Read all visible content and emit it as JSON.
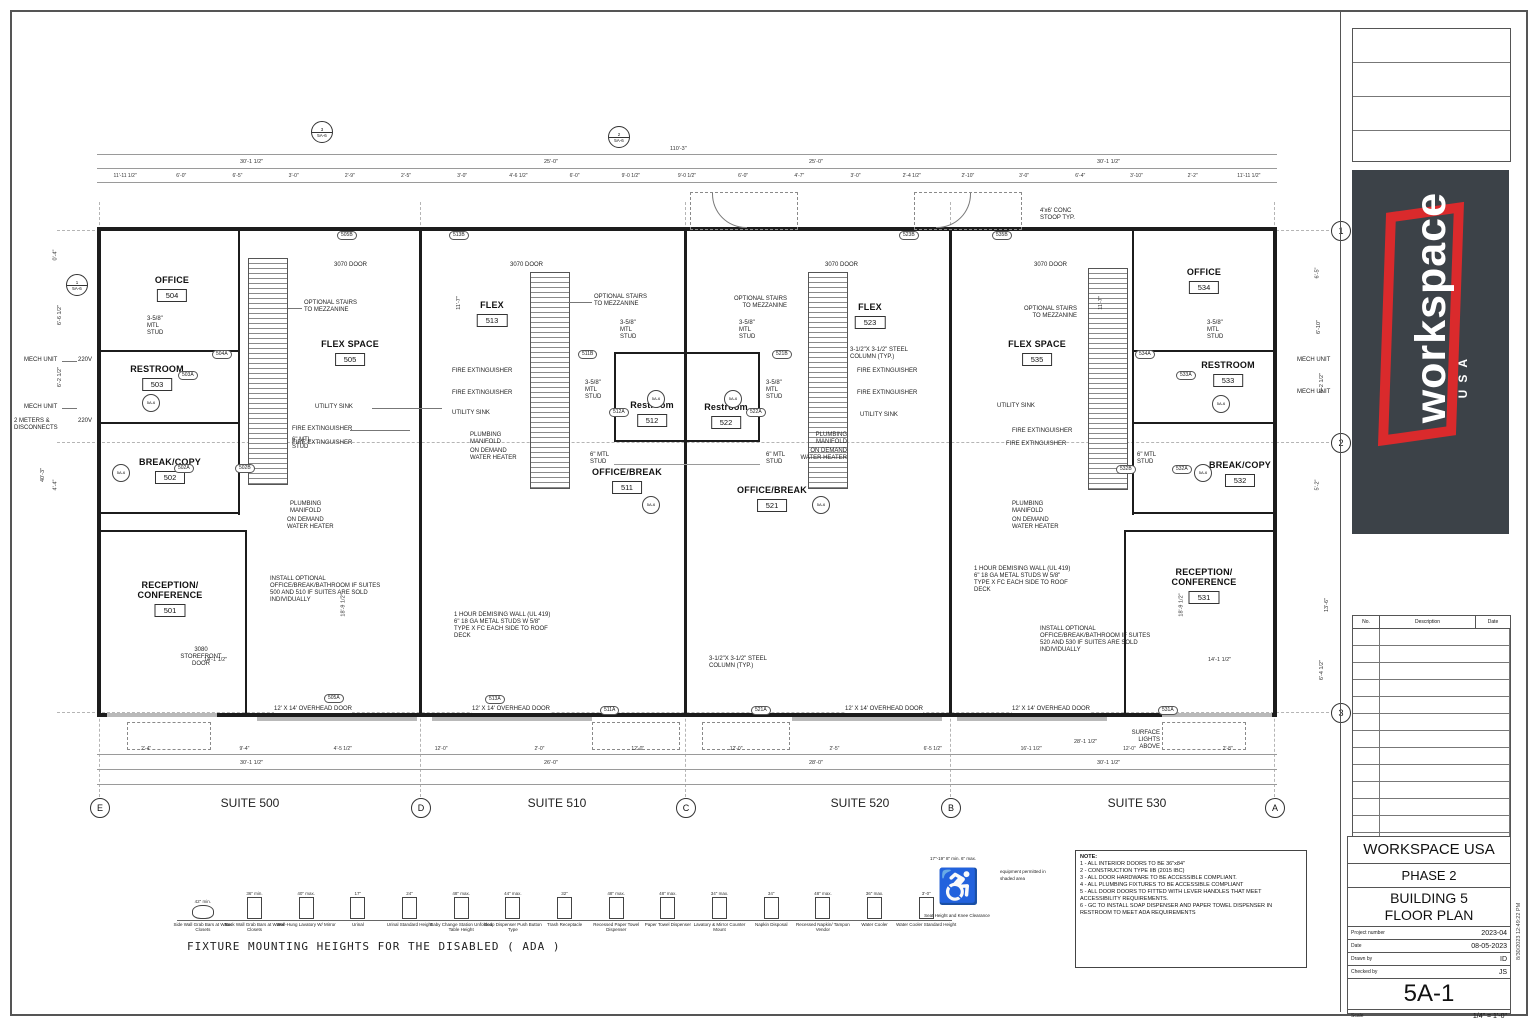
{
  "sheet": {
    "firm": "WORKSPACE USA",
    "phase": "PHASE 2",
    "title_line1": "BUILDING  5",
    "title_line2": "FLOOR PLAN",
    "project_number_label": "Project number",
    "project_number": "2023-04",
    "date_label": "Date",
    "date": "08-05-2023",
    "drawn_label": "Drawn by",
    "drawn": "ID",
    "checked_label": "Checked by",
    "checked": "JS",
    "sheet_number": "5A-1",
    "scale_label": "Scale",
    "scale": "1/4\" = 1'-0\"",
    "plot_stamp": "8/30/2023 12:49:22 PM",
    "revision_headers": {
      "no": "No.",
      "description": "Description",
      "date": "Date"
    }
  },
  "logo": {
    "word": "workspace",
    "sub": "USA",
    "red": "#da2a2c",
    "dark": "#3c4248"
  },
  "grid": {
    "columns": [
      "E",
      "D",
      "C",
      "B",
      "A"
    ],
    "rows": [
      "1",
      "2",
      "3"
    ]
  },
  "section_markers": {
    "m3": "3",
    "m2": "2",
    "m1": "1",
    "ref": "5A-6"
  },
  "suites": [
    "SUITE 500",
    "SUITE 510",
    "SUITE 520",
    "SUITE 530"
  ],
  "rooms": [
    {
      "name": "OFFICE",
      "number": "504"
    },
    {
      "name": "RESTROOM",
      "number": "503"
    },
    {
      "name": "BREAK/COPY",
      "number": "502"
    },
    {
      "name": "RECEPTION/\nCONFERENCE",
      "number": "501"
    },
    {
      "name": "FLEX SPACE",
      "number": "505"
    },
    {
      "name": "FLEX",
      "number": "513"
    },
    {
      "name": "Restroom",
      "number": "512"
    },
    {
      "name": "OFFICE/BREAK",
      "number": "511"
    },
    {
      "name": "FLEX",
      "number": "523"
    },
    {
      "name": "Restroom",
      "number": "522"
    },
    {
      "name": "OFFICE/BREAK",
      "number": "521"
    },
    {
      "name": "FLEX SPACE",
      "number": "535"
    },
    {
      "name": "OFFICE",
      "number": "534"
    },
    {
      "name": "RESTROOM",
      "number": "533"
    },
    {
      "name": "BREAK/COPY",
      "number": "532"
    },
    {
      "name": "RECEPTION/\nCONFERENCE",
      "number": "531"
    }
  ],
  "ann": {
    "door3070": "3070 DOOR",
    "stairs": "OPTIONAL STAIRS\nTO MEZZANINE",
    "fire_ext": "FIRE EXTINGUISHER",
    "utility_sink": "UTILITY SINK",
    "plumbing": "PLUMBING\nMANIFOLD",
    "water_heater": "ON DEMAND\nWATER HEATER",
    "stud358": "3-5/8\"\nMTL\nSTUD",
    "stud6": "6\" MTL\nSTUD",
    "demising": "1 HOUR DEMISING WALL (UL 419)\n6\" 18 GA METAL STUDS W 5/8\"\nTYPE X FC EACH SIDE TO ROOF\nDECK",
    "column": "3-1/2\"X 3-1/2\" STEEL\nCOLUMN (TYP.)",
    "install_left": "INSTALL OPTIONAL\nOFFICE/BREAK/BATHROOM IF SUITES\n500 AND 510 IF SUITES ARE SOLD\nINDIVIDUALLY",
    "install_right": "INSTALL OPTIONAL\nOFFICE/BREAK/BATHROOM IF SUITES\n520 AND 530 IF SUITES ARE SOLD\nINDIVIDUALLY",
    "storefront": "3080\nSTOREFRONT\nDOOR",
    "overhead": "12' X 14' OVERHEAD DOOR",
    "surface_lights": "SURFACE\nLIGHTS\nABOVE",
    "stoop": "4'x6' CONC\nSTOOP TYP.",
    "mech": "MECH UNIT",
    "meters": "2 METERS &\nDISCONNECTS",
    "v220": "220V"
  },
  "door_tags": [
    "505B",
    "513B",
    "523B",
    "535B",
    "504A",
    "503A",
    "502A",
    "502B",
    "511B",
    "512A",
    "521B",
    "522A",
    "534A",
    "533A",
    "532A",
    "532B",
    "505A",
    "513A",
    "511A",
    "521A",
    "531A"
  ],
  "dims": {
    "overall": "110'-3\"",
    "tier2": [
      "30'-1 1/2\"",
      "25'-0\"",
      "25'-0\"",
      "30'-1 1/2\""
    ],
    "tier3": [
      "11'-11 1/2\"",
      "6'-0\"",
      "6'-5\"",
      "3'-0\"",
      "2'-9\"",
      "2'-5\"",
      "3'-0\"",
      "4'-6 1/2\"",
      "6'-0\"",
      "9'-0 1/2\"",
      "9'-0 1/2\"",
      "6'-0\"",
      "4'-7\"",
      "3'-0\"",
      "2'-4 1/2\"",
      "2'-10\"",
      "3'-0\"",
      "6'-4\"",
      "3'-10\"",
      "2'-2\"",
      "11'-11 1/2\""
    ],
    "bottom_sub": [
      "2'-4\"",
      "9'-4\"",
      "4'-5 1/2\"",
      "12'-0\"",
      "2'-0\"",
      "12'-0\"",
      "12'-0\"",
      "2'-5\"",
      "6'-5 1/2\"",
      "16'-1 1/2\"",
      "12'-0\"",
      "2'-8\""
    ],
    "bottom_tier2": [
      "30'-1 1/2\"",
      "26'-0\"",
      "28'-0\"",
      "30'-1 1/2\""
    ],
    "bottom_extra": "28'-1 1/2\"",
    "left": [
      "0'-4\"",
      "6'-6 1/2\"",
      "6'-2 1/2\"",
      "4'-4\"",
      "40'-3\""
    ],
    "right": [
      "6'-5\"",
      "6'-10\"",
      "6'-2 1/2\"",
      "5'-2\"",
      "13'-6\"",
      "6'-4 1/2\""
    ],
    "interior": {
      "recep_depth": "18'-9 1/2\"",
      "recep_width": "14'-1 1/2\"",
      "flex_front": "11'-7\""
    }
  },
  "notes": {
    "title": "NOTE:",
    "items": [
      "1 - ALL INTERIOR DOORS TO BE 36\"x84\"",
      "2 - CONSTRUCTION TYPE IIB (2015 IBC)",
      "3 - ALL DOOR HARDWARE TO BE ACCESSIBLE COMPLIANT.",
      "4 - ALL PLUMBING FIXTURES TO BE ACCESSIBLE COMPLIANT",
      "5 - ALL DOOR DOORS TO FITTED WITH LEVER HANDLES THAT MEET ACCESSIBILITY REQUIREMENTS.",
      "6 - GC TO INSTALL SOAP DISPENSER AND PAPER TOWEL DISPENSER IN RESTROOM TO MEET ADA REQUIREMENTS"
    ]
  },
  "ada": {
    "caption": "FIXTURE MOUNTING HEIGHTS FOR THE DISABLED ( ADA )",
    "fixtures": [
      {
        "label": "Side Wall Grab Bars at Water Closets",
        "dim": "42\" min."
      },
      {
        "label": "Back Wall Grab Bars at Water Closets",
        "dim": "36\" min."
      },
      {
        "label": "Wall-Hung Lavatory W/ Mirror",
        "dim": "40\" max."
      },
      {
        "label": "Urinal",
        "dim": "17\""
      },
      {
        "label": "Urinal Standard Height",
        "dim": "24\""
      },
      {
        "label": "Baby Change Station Unfolded Table Height",
        "dim": "48\" max."
      },
      {
        "label": "Soap Dispenser Push Button Type",
        "dim": "44\" max."
      },
      {
        "label": "Trash Receptacle",
        "dim": "32\""
      },
      {
        "label": "Recessed Paper Towel Dispenser",
        "dim": "48\" max."
      },
      {
        "label": "Paper Towel Dispenser",
        "dim": "48\" max."
      },
      {
        "label": "Lavatory & Mirror Counter Mount",
        "dim": "34\" max."
      },
      {
        "label": "Napkin Disposal",
        "dim": "34\""
      },
      {
        "label": "Recessed Napkin/ Tampon Vendor",
        "dim": "48\" max."
      },
      {
        "label": "Water Cooler",
        "dim": "36\" max."
      },
      {
        "label": "Water Cooler Standard Height",
        "dim": "3'-0\""
      }
    ],
    "wheelchair": {
      "label": "Seat Height and Knee Clearance",
      "note": "equipment permitted in shaded area",
      "dims": "17\"-19\"   8\" min.   6\" max."
    }
  }
}
